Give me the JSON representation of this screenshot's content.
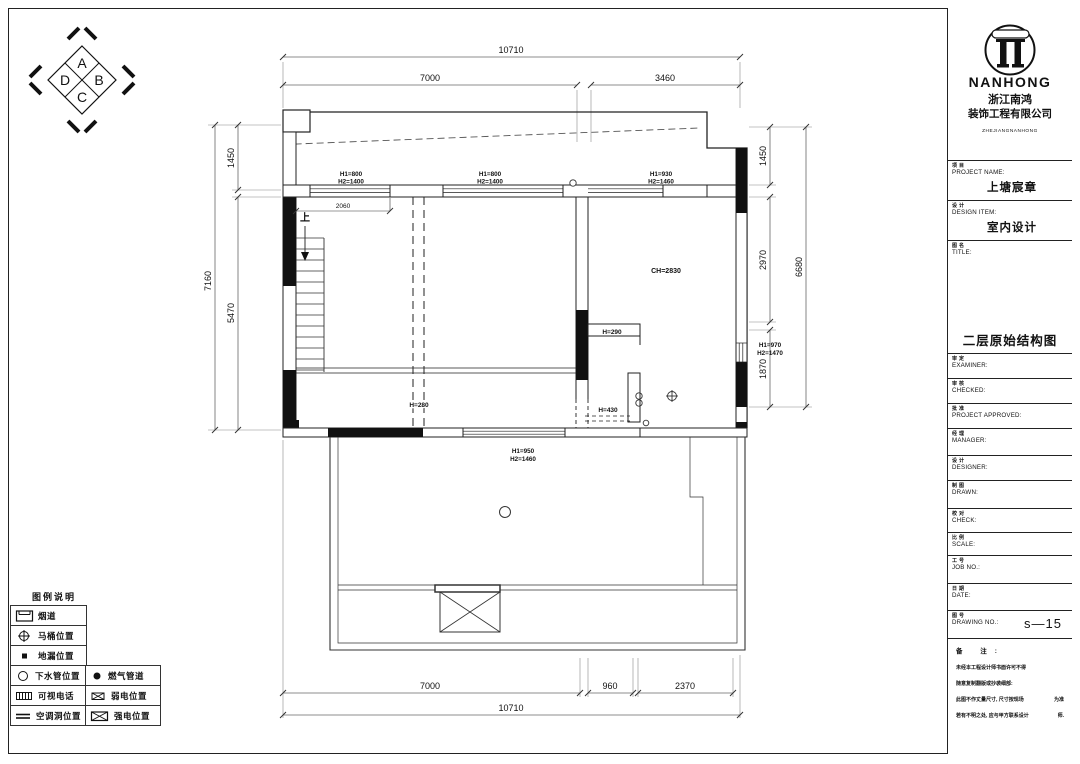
{
  "compass": {
    "top": "A",
    "right": "B",
    "bottom": "C",
    "left": "D"
  },
  "plan": {
    "dims": {
      "top_total": "10710",
      "top_left": "7000",
      "top_right": "3460",
      "left_outer": "7160",
      "left_top": "1450",
      "left_bottom": "5470",
      "right_top": "1450",
      "right_mid": "2970",
      "right_bottom": "1870",
      "right_outer": "6680",
      "bottom_left": "7000",
      "bottom_mid": "960",
      "bottom_right": "2370",
      "bottom_total": "10710",
      "stair_width": "2060"
    },
    "windows": {
      "north_left_h1": "H1=800",
      "north_left_h2": "H2=1400",
      "north_mid_h1": "H1=800",
      "north_mid_h2": "H2=1400",
      "north_right_h1": "H1=930",
      "north_right_h2": "H2=1460",
      "east_h1": "H1=970",
      "east_h2": "H2=1470",
      "south_h1": "H1=950",
      "south_h2": "H2=1460"
    },
    "annotations": {
      "ceiling_height": "CH=2830",
      "beam_height": "H=280",
      "opening_height": "H=290",
      "sill_height": "H=430",
      "stair_up": "上"
    }
  },
  "legend": {
    "title": "图例说明",
    "items": [
      {
        "label": "烟道"
      },
      {
        "label": "马桶位置"
      },
      {
        "label": "地漏位置"
      },
      {
        "label": "下水管位置"
      },
      {
        "label": "燃气管道"
      },
      {
        "label": "可视电话"
      },
      {
        "label": "弱电位置"
      },
      {
        "label": "空调洞位置"
      },
      {
        "label": "强电位置"
      }
    ]
  },
  "title_block": {
    "brand": "NANHONG",
    "company_line1": "浙江南鸿",
    "company_line2": "装饰工程有限公司",
    "company_en": "ZHEJIANGNANHONG",
    "project": {
      "cn": "项目",
      "en": "PROJECT NAME:",
      "value": "上塘宸章"
    },
    "design": {
      "cn": "设计",
      "en": "DESIGN ITEM:",
      "value": "室内设计"
    },
    "title": {
      "cn": "图名",
      "en": "TITLE:",
      "value": "二层原始结构图"
    },
    "examiner": {
      "cn": "审定",
      "en": "EXAMINER:"
    },
    "checked": {
      "cn": "审核",
      "en": "CHECKED:"
    },
    "approved": {
      "cn": "批准",
      "en": "PROJECT  APPROVED:"
    },
    "manager": {
      "cn": "经理",
      "en": "MANAGER:"
    },
    "designer": {
      "cn": "设计",
      "en": "DESIGNER:"
    },
    "drawn": {
      "cn": "制图",
      "en": "DRAWN:"
    },
    "check": {
      "cn": "校对",
      "en": "CHECK:"
    },
    "scale": {
      "cn": "比例",
      "en": "SCALE:"
    },
    "job": {
      "cn": "工号",
      "en": "JOB  NO.:"
    },
    "date": {
      "cn": "日期",
      "en": "DATE:"
    },
    "drawing_no": {
      "cn": "图号",
      "en": "DRAWING NO.:",
      "value": "s—15"
    },
    "notes": {
      "title": "备 注:",
      "line1": "未经本工程设计师书面许可不得",
      "line2": "随意复制翻版或抄袭细部:",
      "line3": "此图不作丈量尺寸, 尺寸按现场",
      "line3r": "为准",
      "line4": "若有不明之处, 应与甲方联系设计",
      "line4r": "师."
    }
  }
}
